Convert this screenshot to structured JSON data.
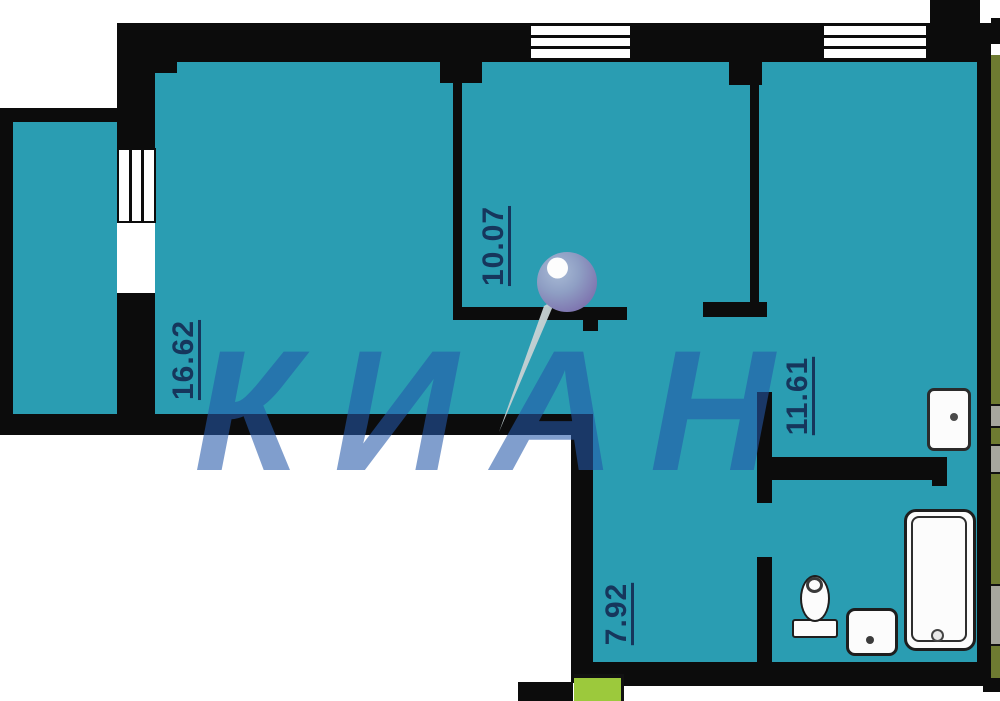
{
  "watermark": {
    "text": "КИАН",
    "color": "#2458a6"
  },
  "rooms": [
    {
      "area": "16.62"
    },
    {
      "area": "10.07"
    },
    {
      "area": "11.61"
    },
    {
      "area": "7.92"
    }
  ],
  "fixtures": [
    "bathtub",
    "sink",
    "toilet",
    "washing-machine"
  ],
  "icons": {
    "watermark_pin": "pin-icon"
  },
  "colors": {
    "floor_teal": "#2a9db2",
    "wall_black": "#0c0c0c",
    "label_navy": "#16365c",
    "entrance_green": "#9cc93c",
    "adjacent_olive": "#6e7b31",
    "watermark_blue": "#2458a6"
  }
}
